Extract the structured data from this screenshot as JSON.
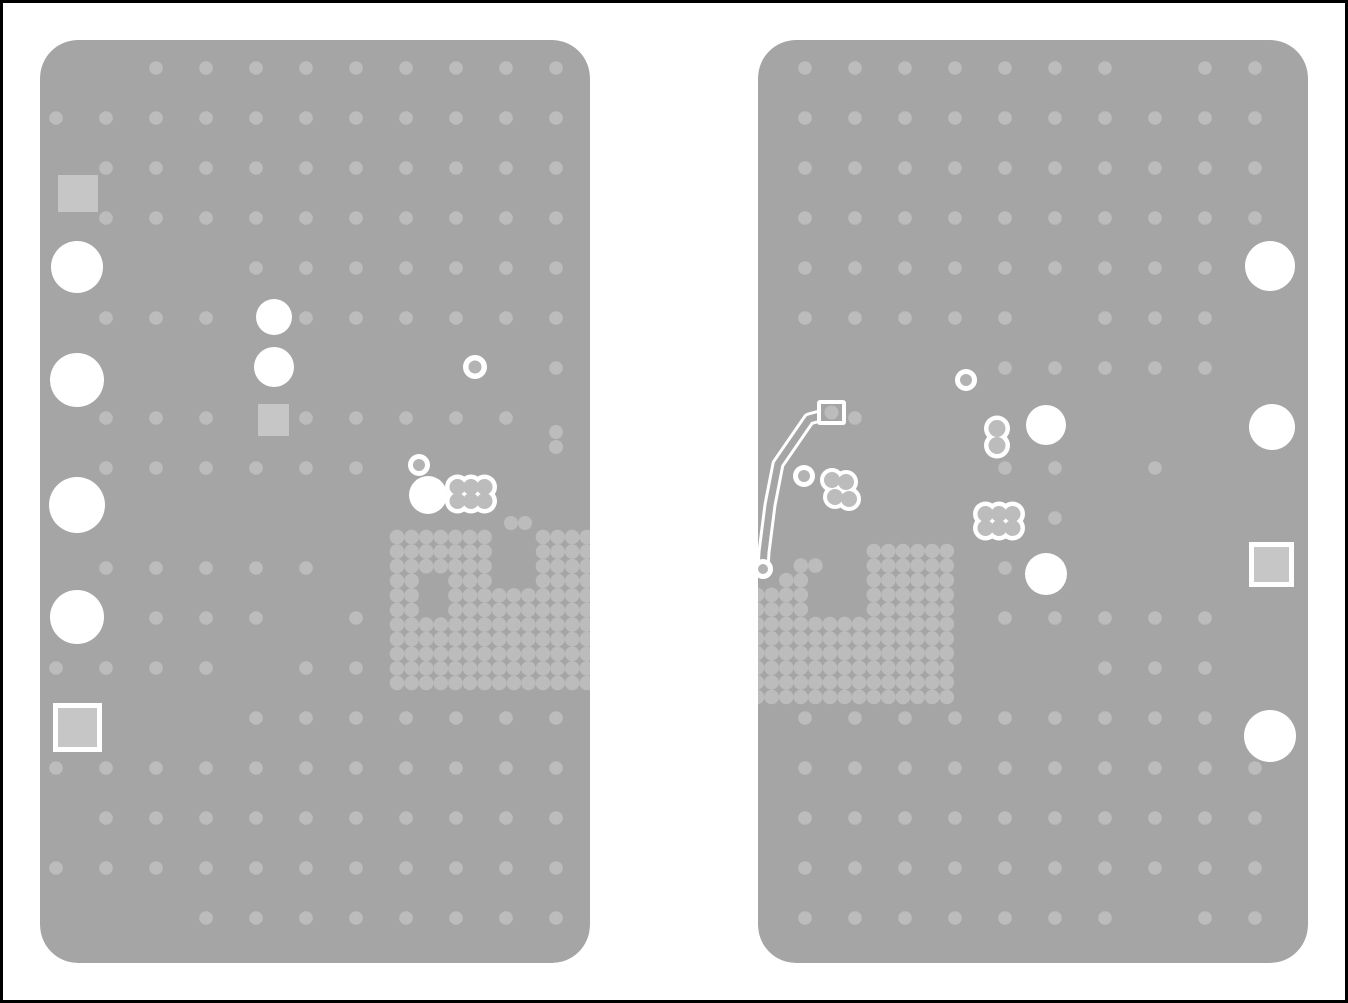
{
  "meta": {
    "description": "PCB layer rendering, two board panels with via grids, drill holes, pads and one routed trace"
  },
  "canvas": {
    "width": 1348,
    "height": 1003,
    "background": "#ffffff",
    "border_color": "#000000",
    "border_width": 3
  },
  "colors": {
    "board": "#a5a5a5",
    "grid_dot": "#bcbcbc",
    "pad_fill": "#c6c6c6",
    "white": "#ffffff",
    "ring_center": "#b3b3b3"
  },
  "boards": [
    {
      "name": "left-board",
      "x": 40,
      "y": 40,
      "width": 550,
      "height": 923,
      "corner_radius": 38,
      "grid": {
        "x0": 56,
        "y0": 68,
        "pitch": 50,
        "cols": 11,
        "rows": 18,
        "dot_r": 6.8,
        "row_masks": [
          "00111111111",
          "11111111111",
          "01111111111",
          "01111111111",
          "00001111111",
          "01110111111",
          "00000000001",
          "01110111110",
          "01111110000",
          "00000000000",
          "01111100000",
          "00111010000",
          "11110110000",
          "00001111111",
          "11111111111",
          "01111111111",
          "11111111111",
          "00011111111"
        ]
      },
      "extra_dots": [
        [
          556,
          432
        ],
        [
          556,
          447
        ],
        [
          511,
          523
        ],
        [
          525,
          523
        ]
      ],
      "via_array": {
        "x0": 397,
        "y0": 537,
        "pitch": 14.6,
        "cols": 14,
        "rows": 11,
        "dot_r": 7.3,
        "gap_rects": [
          [
            420,
            571,
            32,
            47
          ],
          [
            488,
            528,
            48,
            65
          ]
        ]
      },
      "squares": [
        [
          58,
          175,
          40,
          37
        ],
        [
          258,
          404,
          31,
          32
        ]
      ],
      "bordered_squares": [
        [
          53,
          703,
          49,
          49
        ]
      ],
      "holes": [
        [
          77,
          267,
          26
        ],
        [
          77,
          380,
          27
        ],
        [
          77,
          505,
          28
        ],
        [
          77,
          617,
          27
        ],
        [
          274,
          317,
          18
        ],
        [
          274,
          367,
          20
        ],
        [
          428,
          495,
          19
        ]
      ],
      "rings": [
        [
          475,
          367,
          12,
          6.5
        ],
        [
          419,
          465,
          11,
          6
        ]
      ],
      "clusters6": [
        [
          471,
          494
        ]
      ],
      "clusters2": [],
      "clusters4": [],
      "trace": null
    },
    {
      "name": "right-board",
      "x": 758,
      "y": 40,
      "width": 550,
      "height": 923,
      "corner_radius": 38,
      "grid": {
        "x0": 805,
        "y0": 68,
        "pitch": 50,
        "cols": 10,
        "rows": 18,
        "dot_r": 6.8,
        "row_masks": [
          "1111111011",
          "1111111111",
          "1111111111",
          "1111111111",
          "1111111110",
          "1111101110",
          "0000111110",
          "0100000000",
          "0000110100",
          "0000010000",
          "0000100000",
          "0000111110",
          "0000001110",
          "1111111110",
          "1111111111",
          "1111111111",
          "1111111111",
          "1111111011"
        ]
      },
      "extra_dots": [],
      "via_array": {
        "x0": 757,
        "y0": 551,
        "pitch": 14.6,
        "cols": 14,
        "rows": 11,
        "dot_r": 7.3,
        "row_masks": [
          "00000000111111",
          "00011000111111",
          "00110000111111",
          "11110000111111",
          "11110000111111",
          "11111111111111",
          "11111111111111",
          "11111111111111",
          "11111111111111",
          "11111111111111",
          "11111111111111"
        ]
      },
      "squares": [],
      "bordered_squares": [
        [
          1249,
          542,
          45,
          45
        ]
      ],
      "holes": [
        [
          1046,
          425,
          20
        ],
        [
          1046,
          574,
          21
        ],
        [
          1270,
          266,
          25
        ],
        [
          1272,
          427,
          23
        ],
        [
          1270,
          736,
          26
        ]
      ],
      "rings": [
        [
          966,
          380,
          11,
          6
        ],
        [
          804,
          476,
          11,
          6
        ],
        [
          763,
          569,
          10,
          5
        ]
      ],
      "clusters6": [
        [
          999,
          521
        ]
      ],
      "clusters2": [
        [
          997,
          437
        ]
      ],
      "clusters4": [
        [
          840,
          489
        ]
      ],
      "trace": {
        "points": [
          [
            831,
            413
          ],
          [
            809,
            419
          ],
          [
            778,
            464
          ],
          [
            770,
            505
          ],
          [
            764,
            552
          ],
          [
            763,
            569
          ]
        ],
        "outer_width": 13,
        "inner_width": 7,
        "pad": {
          "x": 817,
          "y": 400,
          "w": 29,
          "h": 25,
          "dot_r": 7
        }
      }
    }
  ]
}
